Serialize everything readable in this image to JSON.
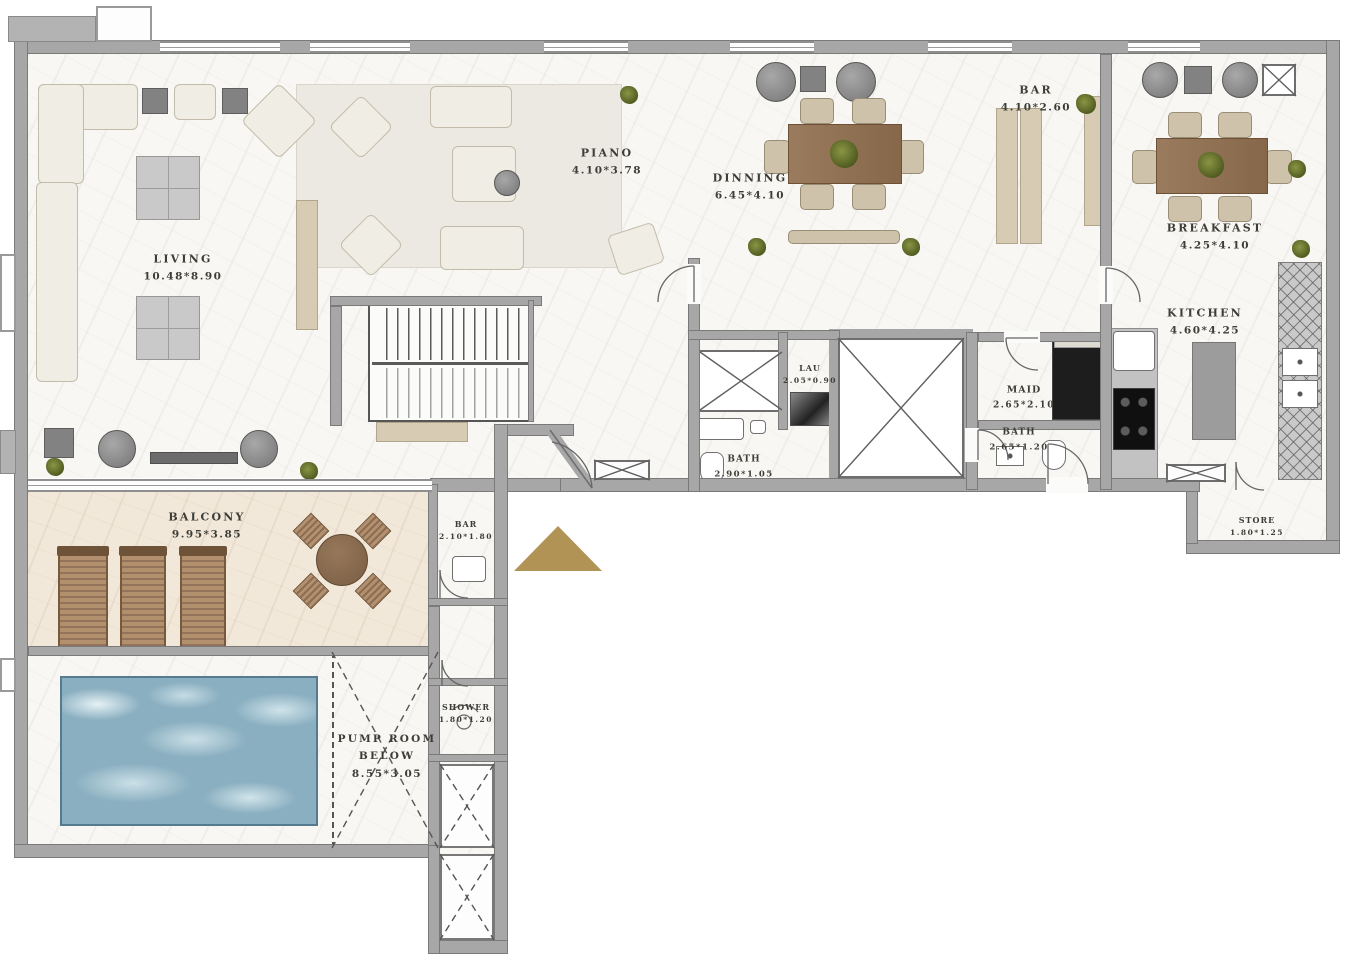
{
  "rooms": {
    "living": {
      "name": "LIVING",
      "dims": "10.48*8.90"
    },
    "piano": {
      "name": "PIANO",
      "dims": "4.10*3.78"
    },
    "dinning": {
      "name": "DINNING",
      "dims": "6.45*4.10"
    },
    "bar": {
      "name": "BAR",
      "dims": "4.10*2.60"
    },
    "breakfast": {
      "name": "BREAKFAST",
      "dims": "4.25*4.10"
    },
    "kitchen": {
      "name": "KITCHEN",
      "dims": "4.60*4.25"
    },
    "maid": {
      "name": "MAID",
      "dims": "2.65*2.10"
    },
    "bath_maid": {
      "name": "BATH",
      "dims": "2.65*1.20"
    },
    "lau": {
      "name": "LAU",
      "dims": "2.05*0.90"
    },
    "bath_guest": {
      "name": "BATH",
      "dims": "2.90*1.05"
    },
    "store": {
      "name": "STORE",
      "dims": "1.80*1.25"
    },
    "balcony": {
      "name": "BALCONY",
      "dims": "9.95*3.85"
    },
    "bar_balcony": {
      "name": "BAR",
      "dims": "2.10*1.80"
    },
    "shower": {
      "name": "SHOWER",
      "dims": "1.80*1.20"
    },
    "pump_room": {
      "name": "PUMP ROOM BELOW",
      "dims": "8.55*3.05"
    }
  },
  "colors": {
    "wall": "#a7a7a7",
    "wall_edge": "#7a7a7a",
    "floor": "#f8f7f4",
    "balcony_floor": "#f2e8da",
    "pool_water": "#8aafc0",
    "entrance_marker": "#b19355",
    "wood": "#9b7b5d",
    "label_text": "#3d3d37"
  }
}
